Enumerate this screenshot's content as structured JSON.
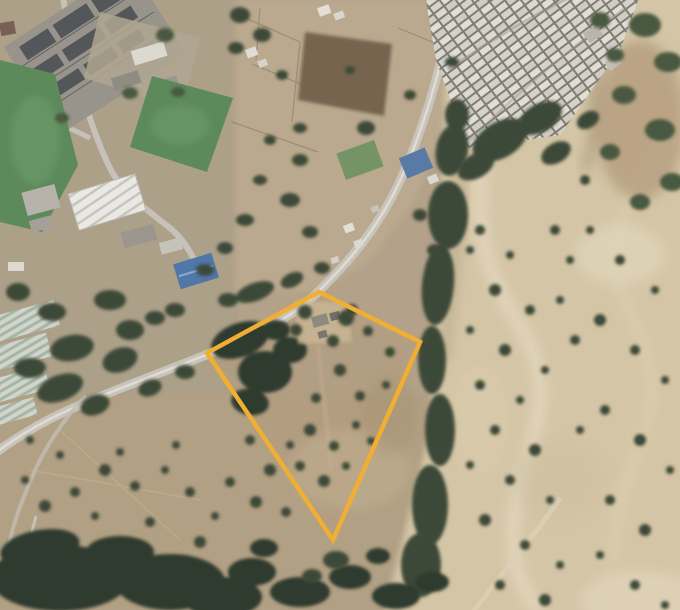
{
  "meta": {
    "kind": "satellite-aerial-view",
    "width": 680,
    "height": 610,
    "visible_text": "none"
  },
  "annotation": {
    "parcel": {
      "points": "319,292 420,342 333,540 207,353",
      "stroke": "#F0AF33",
      "stroke_width": 4.5,
      "fill": "none"
    }
  },
  "colors": {
    "base": "#b3a289",
    "leftGround": "#aca089",
    "southGround": "#b1a084",
    "topmidGround": "#bcab90",
    "parcelGround": "#b29c7d",
    "hillside": "#d4c5a6",
    "hillLight": "#e2d6bc",
    "hillWash2": "#ddcfb1",
    "paleBlob": "#d9cbab",
    "brownSlope": "#a58a6a",
    "shadowBrown": "#8f7a5f",
    "road": "#c8c4bb",
    "roadCenter": "#e2dfd8",
    "roadMinor": "#c6c2b9",
    "track": "#ccc9c0",
    "hillTrack": "#dcd0b6",
    "field": "#5c8a5b",
    "fieldLight": "#6f9e6b",
    "treeDark": "#3c4837",
    "treeDarker": "#2f3a2e",
    "treeMid": "#4a5941",
    "substationGround": "#98948b",
    "substationBlock": "#54575a",
    "warehouseStripeFill": "#e9e8e3",
    "greenhouseFill": "#cfd5ca",
    "blueRoof": "#4f77a8",
    "blueRoof2": "#587aa4",
    "houseGap": "#817d75",
    "darkField": "#6f5d49",
    "yard": "#c9b794",
    "wall": "#6f6552",
    "greenPatch": "#67905f"
  },
  "vegetation": {
    "ravine_clusters": [
      [
        457,
        115,
        12,
        16,
        0
      ],
      [
        452,
        150,
        16,
        26,
        10
      ],
      [
        448,
        215,
        20,
        34,
        0
      ],
      [
        438,
        285,
        16,
        40,
        5
      ],
      [
        432,
        360,
        14,
        34,
        0
      ],
      [
        440,
        430,
        15,
        36,
        0
      ],
      [
        430,
        505,
        18,
        40,
        0
      ],
      [
        421,
        565,
        20,
        32,
        0
      ]
    ],
    "settlement_south": [
      [
        500,
        140,
        30,
        18,
        -30
      ],
      [
        540,
        118,
        24,
        14,
        -30
      ],
      [
        476,
        166,
        20,
        12,
        -30
      ],
      [
        556,
        153,
        16,
        10,
        -30
      ],
      [
        588,
        120,
        12,
        8,
        -30
      ]
    ],
    "topright_slope": [
      [
        645,
        25,
        16,
        12,
        0
      ],
      [
        668,
        62,
        14,
        10,
        0
      ],
      [
        624,
        95,
        12,
        9,
        0
      ],
      [
        660,
        130,
        15,
        11,
        0
      ],
      [
        610,
        152,
        10,
        8,
        0
      ],
      [
        672,
        182,
        12,
        9,
        0
      ],
      [
        640,
        202,
        10,
        8,
        0
      ],
      [
        600,
        20,
        10,
        8,
        0
      ],
      [
        615,
        55,
        9,
        7,
        0
      ]
    ],
    "midleft_band": [
      [
        120,
        360,
        18,
        12,
        -20
      ],
      [
        60,
        388,
        24,
        13,
        -20
      ],
      [
        95,
        405,
        15,
        10,
        -20
      ],
      [
        130,
        330,
        14,
        10,
        0
      ],
      [
        72,
        348,
        22,
        13,
        -10
      ],
      [
        30,
        368,
        16,
        10,
        0
      ],
      [
        155,
        318,
        10,
        7,
        0
      ],
      [
        175,
        310,
        10,
        7,
        0
      ],
      [
        110,
        300,
        16,
        10,
        0
      ],
      [
        52,
        312,
        14,
        9,
        0
      ],
      [
        18,
        292,
        12,
        9,
        0
      ],
      [
        150,
        388,
        12,
        8,
        -20
      ],
      [
        185,
        372,
        10,
        7,
        0
      ]
    ],
    "road_north": [
      [
        255,
        292,
        20,
        9,
        -20
      ],
      [
        292,
        280,
        12,
        7,
        -25
      ],
      [
        228,
        300,
        10,
        7,
        0
      ],
      [
        322,
        268,
        8,
        6,
        0
      ]
    ],
    "orchard": [
      [
        240,
        340,
        30,
        17,
        -20
      ],
      [
        265,
        372,
        27,
        21,
        0
      ],
      [
        250,
        402,
        19,
        13,
        10
      ],
      [
        290,
        350,
        17,
        13,
        0
      ],
      [
        276,
        330,
        14,
        10,
        0
      ]
    ],
    "compound_trees": [
      [
        305,
        312,
        7
      ],
      [
        346,
        318,
        8
      ],
      [
        333,
        341,
        6
      ],
      [
        296,
        330,
        6
      ]
    ],
    "parcel_inner": [
      [
        352,
        310,
        6
      ],
      [
        368,
        331,
        5
      ],
      [
        390,
        352,
        5
      ],
      [
        340,
        370,
        6
      ],
      [
        360,
        396,
        5
      ],
      [
        386,
        385,
        4
      ],
      [
        310,
        430,
        6
      ],
      [
        334,
        446,
        5
      ],
      [
        356,
        425,
        4
      ],
      [
        300,
        466,
        5
      ],
      [
        324,
        481,
        6
      ],
      [
        346,
        466,
        4
      ],
      [
        371,
        441,
        4
      ],
      [
        290,
        445,
        4
      ],
      [
        316,
        398,
        5
      ],
      [
        336,
        560,
        13,
        9,
        0
      ],
      [
        312,
        576,
        10,
        7,
        0
      ]
    ],
    "left_scrub": [
      [
        250,
        440,
        5
      ],
      [
        270,
        470,
        6
      ],
      [
        230,
        482,
        5
      ],
      [
        256,
        502,
        6
      ],
      [
        286,
        512,
        5
      ],
      [
        215,
        516,
        4
      ],
      [
        190,
        492,
        5
      ],
      [
        165,
        470,
        4
      ],
      [
        135,
        486,
        5
      ],
      [
        105,
        470,
        6
      ],
      [
        75,
        492,
        5
      ],
      [
        45,
        506,
        6
      ],
      [
        25,
        480,
        4
      ],
      [
        95,
        516,
        4
      ],
      [
        150,
        522,
        5
      ],
      [
        200,
        542,
        6
      ],
      [
        176,
        445,
        4
      ],
      [
        120,
        452,
        4
      ],
      [
        60,
        455,
        4
      ],
      [
        30,
        440,
        4
      ]
    ],
    "bottom_forest": [
      [
        60,
        578,
        70,
        33,
        0
      ],
      [
        170,
        582,
        55,
        28,
        0
      ],
      [
        40,
        548,
        40,
        18,
        -10
      ],
      [
        120,
        552,
        34,
        16,
        0
      ],
      [
        222,
        597,
        40,
        20,
        0
      ],
      [
        252,
        572,
        24,
        14,
        0
      ],
      [
        300,
        592,
        30,
        15,
        0
      ],
      [
        350,
        577,
        21,
        12,
        0
      ],
      [
        396,
        596,
        24,
        13,
        0
      ],
      [
        432,
        582,
        17,
        10,
        0
      ],
      [
        264,
        548,
        14,
        9,
        0
      ],
      [
        378,
        556,
        12,
        8,
        0
      ]
    ],
    "hill_shrubs": [
      [
        480,
        230,
        5
      ],
      [
        510,
        255,
        4
      ],
      [
        495,
        290,
        6
      ],
      [
        530,
        310,
        5
      ],
      [
        470,
        330,
        4
      ],
      [
        505,
        350,
        6
      ],
      [
        545,
        370,
        4
      ],
      [
        480,
        385,
        5
      ],
      [
        520,
        400,
        4
      ],
      [
        495,
        430,
        5
      ],
      [
        535,
        450,
        6
      ],
      [
        470,
        465,
        4
      ],
      [
        510,
        480,
        5
      ],
      [
        550,
        500,
        4
      ],
      [
        485,
        520,
        6
      ],
      [
        525,
        545,
        5
      ],
      [
        560,
        565,
        4
      ],
      [
        500,
        585,
        5
      ],
      [
        545,
        600,
        6
      ],
      [
        590,
        230,
        4
      ],
      [
        620,
        260,
        5
      ],
      [
        655,
        290,
        4
      ],
      [
        600,
        320,
        6
      ],
      [
        635,
        350,
        5
      ],
      [
        665,
        380,
        4
      ],
      [
        605,
        410,
        5
      ],
      [
        640,
        440,
        6
      ],
      [
        670,
        470,
        4
      ],
      [
        610,
        500,
        5
      ],
      [
        645,
        530,
        6
      ],
      [
        600,
        555,
        4
      ],
      [
        635,
        585,
        5
      ],
      [
        665,
        605,
        4
      ],
      [
        585,
        180,
        5
      ],
      [
        570,
        260,
        4
      ],
      [
        575,
        340,
        5
      ],
      [
        580,
        430,
        4
      ],
      [
        560,
        300,
        4
      ],
      [
        555,
        230,
        5
      ],
      [
        470,
        250,
        4
      ]
    ],
    "westroad_trees": [
      [
        366,
        128,
        9,
        7,
        0
      ],
      [
        300,
        128,
        7,
        5,
        0
      ],
      [
        282,
        75,
        6,
        5,
        0
      ],
      [
        350,
        70,
        5,
        4,
        0
      ],
      [
        420,
        215,
        7,
        6,
        0
      ],
      [
        435,
        250,
        8,
        6,
        0
      ],
      [
        410,
        95,
        6,
        5,
        0
      ],
      [
        452,
        62,
        7,
        5,
        0
      ],
      [
        300,
        160,
        8,
        6,
        0
      ],
      [
        270,
        140,
        6,
        5,
        0
      ],
      [
        290,
        200,
        10,
        7,
        0
      ],
      [
        310,
        232,
        8,
        6,
        0
      ],
      [
        260,
        180,
        7,
        5,
        0
      ],
      [
        245,
        220,
        9,
        6,
        0
      ],
      [
        225,
        248,
        8,
        6,
        0
      ],
      [
        205,
        270,
        9,
        6,
        0
      ],
      [
        240,
        15,
        10,
        8,
        0
      ],
      [
        262,
        35,
        9,
        7,
        0
      ],
      [
        236,
        48,
        8,
        6,
        0
      ]
    ],
    "substation_trees": [
      [
        165,
        35,
        9,
        7,
        0
      ],
      [
        130,
        93,
        8,
        6,
        0
      ],
      [
        178,
        92,
        7,
        5,
        0
      ],
      [
        62,
        118,
        7,
        5,
        0
      ]
    ]
  }
}
